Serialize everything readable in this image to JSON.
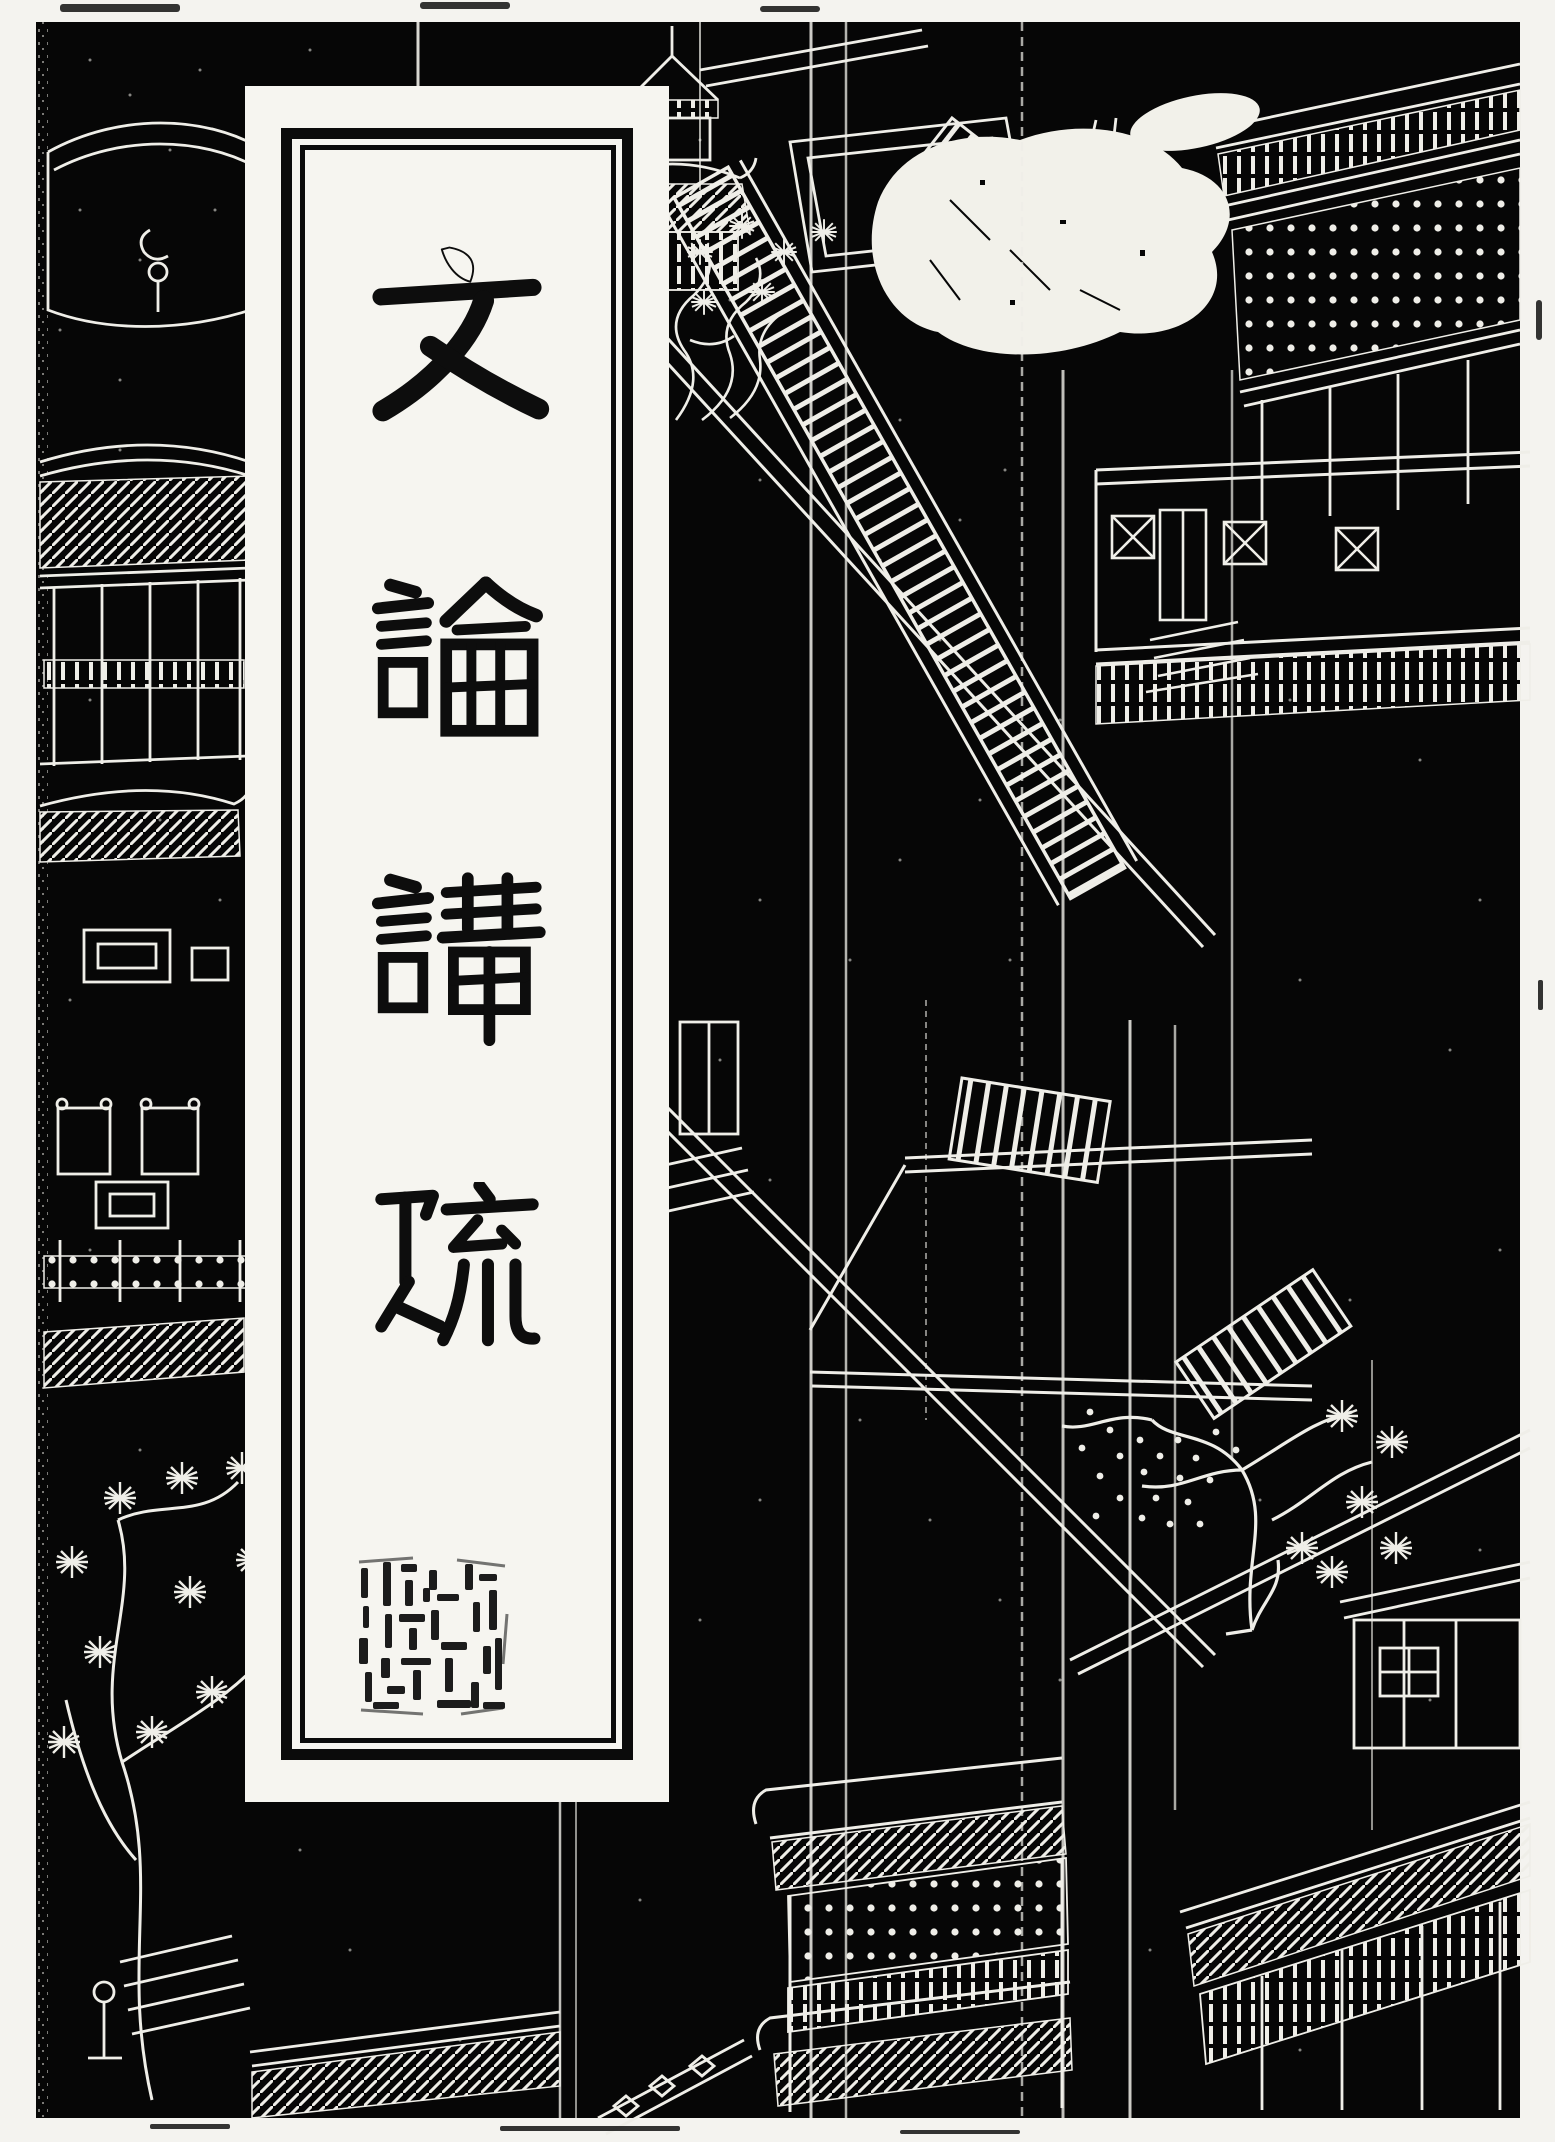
{
  "cover": {
    "title": {
      "text": "文論講疏",
      "characters": [
        "文",
        "論",
        "講",
        "疏"
      ],
      "orientation": "vertical-top-to-bottom"
    },
    "seal": {
      "present": true,
      "legible": false
    },
    "colors": {
      "paper_white": "#f4f3ef",
      "cover_black": "#060606",
      "engraving_line": "#efeee8",
      "title_ink": "#0d0d0d"
    },
    "artwork": {
      "style": "white-line woodblock engraving on black ground",
      "scene": "bird's-eye view of palace courtyards with long stairways, pavilions, galleries, lattice windows, pine and blossom trees",
      "elements": [
        "tiered-pavilion",
        "grand-staircase",
        "courtyard-wall",
        "lattice-windows",
        "gallery-roofs",
        "pine-tree",
        "blossom-tree",
        "gate-tower",
        "terrace-railing",
        "fold-creases",
        "worn-patch"
      ]
    }
  }
}
